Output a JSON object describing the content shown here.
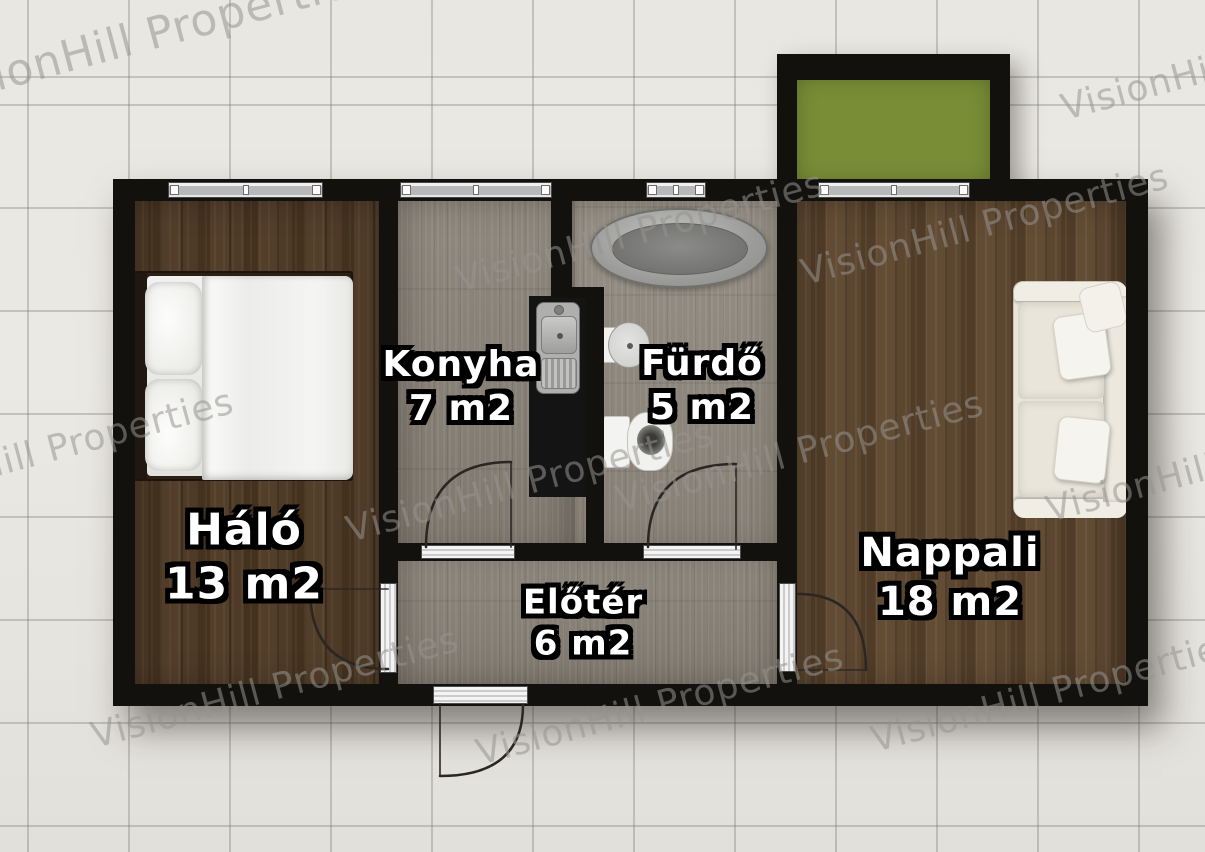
{
  "watermark": {
    "text": "VisionHill Properties"
  },
  "plan": {
    "rooms": [
      {
        "key": "halo",
        "name": "Háló",
        "area": "13 m2"
      },
      {
        "key": "konyha",
        "name": "Konyha",
        "area": "7 m2"
      },
      {
        "key": "furdo",
        "name": "Fürdő",
        "area": "5 m2"
      },
      {
        "key": "eloter",
        "name": "Előtér",
        "area": "6 m2"
      },
      {
        "key": "nappali",
        "name": "Nappali",
        "area": "18 m2"
      }
    ],
    "colors": {
      "wall": "#13110d",
      "bedroom_floor": "#4c3926",
      "living_floor": "#57422c",
      "wet_room_floor": "#8f887e",
      "balcony_grass": "#788d36",
      "background_tile": "#e9e7e2",
      "label_text": "#ffffff"
    }
  }
}
